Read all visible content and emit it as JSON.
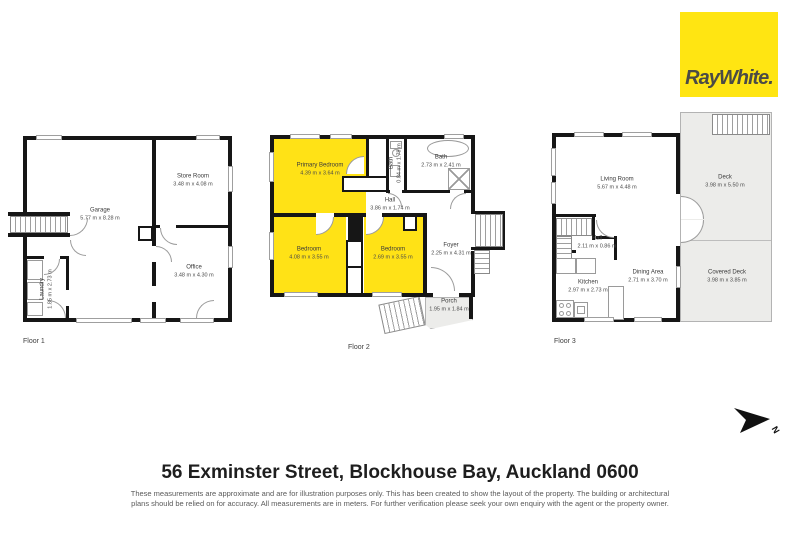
{
  "brand": {
    "logo_text": "RayWhite.",
    "logo_bg": "#ffe512",
    "logo_fg": "#4b4b46"
  },
  "colors": {
    "highlight_room": "#ffe216",
    "deck_fill": "#ececea",
    "wall": "#161616"
  },
  "compass": {
    "label": "N"
  },
  "floors": [
    {
      "label": "Floor 1",
      "rooms": [
        {
          "name": "Garage",
          "dims": "5.77 m x 8.28 m",
          "highlight": false
        },
        {
          "name": "Store Room",
          "dims": "3.48 m x 4.08 m",
          "highlight": false
        },
        {
          "name": "Office",
          "dims": "3.48 m x 4.30 m",
          "highlight": false
        },
        {
          "name": "Laundry",
          "dims": "1.85 m x 2.73 m",
          "highlight": false
        }
      ]
    },
    {
      "label": "Floor 2",
      "rooms": [
        {
          "name": "Primary Bedroom",
          "dims": "4.39 m x 3.64 m",
          "highlight": true
        },
        {
          "name": "Bath",
          "dims": "0.84 m x 1.79 m",
          "highlight": false
        },
        {
          "name": "Bath",
          "dims": "2.73 m x 2.41 m",
          "highlight": false
        },
        {
          "name": "Hall",
          "dims": "3.86 m x 1.74 m",
          "highlight": false
        },
        {
          "name": "Bedroom",
          "dims": "4.08 m x 3.55 m",
          "highlight": true
        },
        {
          "name": "Bedroom",
          "dims": "2.69 m x 3.55 m",
          "highlight": true
        },
        {
          "name": "Foyer",
          "dims": "2.25 m x 4.31 m",
          "highlight": false
        },
        {
          "name": "Porch",
          "dims": "1.95 m x 1.84 m",
          "highlight": false
        }
      ]
    },
    {
      "label": "Floor 3",
      "rooms": [
        {
          "name": "Living Room",
          "dims": "5.67 m x 4.48 m",
          "highlight": false
        },
        {
          "name": "Deck",
          "dims": "3.98 m x 5.50 m",
          "highlight": false
        },
        {
          "name": "Hall",
          "dims": "2.11 m x 0.86 m",
          "highlight": false
        },
        {
          "name": "Kitchen",
          "dims": "2.97 m x 2.73 m",
          "highlight": false
        },
        {
          "name": "Dining Area",
          "dims": "2.71 m x 3.70 m",
          "highlight": false
        },
        {
          "name": "Covered Deck",
          "dims": "3.98 m x 3.85 m",
          "highlight": false
        }
      ]
    }
  ],
  "footer": {
    "address": "56 Exminster Street, Blockhouse Bay, Auckland 0600",
    "disclaimer": "These measurements are approximate and are for illustration purposes only. This has been created to show the layout of the property. The building or architectural plans should be relied on for accuracy. All measurements are in meters. For further verification please seek your own enquiry with the agent or the property owner."
  }
}
